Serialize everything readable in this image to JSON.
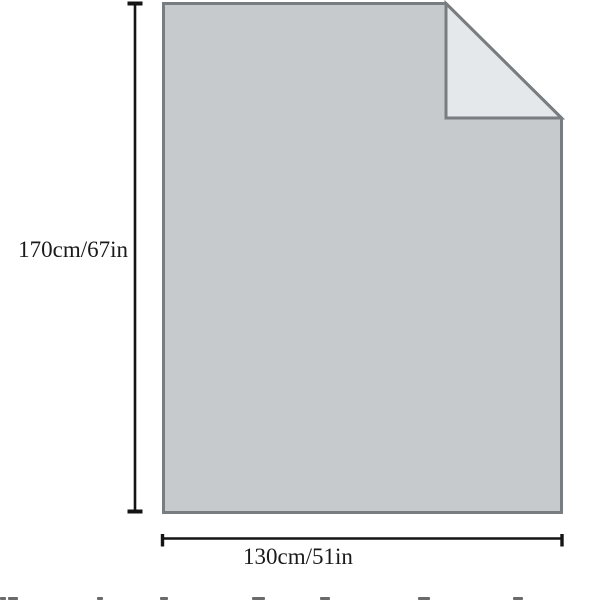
{
  "diagram": {
    "type": "product-dimension-diagram",
    "height_label": "170cm/67in",
    "width_label": "130cm/51in"
  },
  "colors": {
    "background": "#ffffff",
    "sheet-fill": "#c7cacc",
    "fold-fill": "#e5e8ea",
    "outline": "#787d81",
    "dimension-line": "#141414",
    "label-text": "#1a1a1a"
  },
  "cropped_text_marks": [
    {
      "x": 0,
      "w": 6
    },
    {
      "x": 8,
      "w": 10
    },
    {
      "x": 97,
      "w": 6
    },
    {
      "x": 160,
      "w": 8
    },
    {
      "x": 252,
      "w": 13
    },
    {
      "x": 320,
      "w": 10
    },
    {
      "x": 418,
      "w": 12
    },
    {
      "x": 513,
      "w": 10
    }
  ]
}
